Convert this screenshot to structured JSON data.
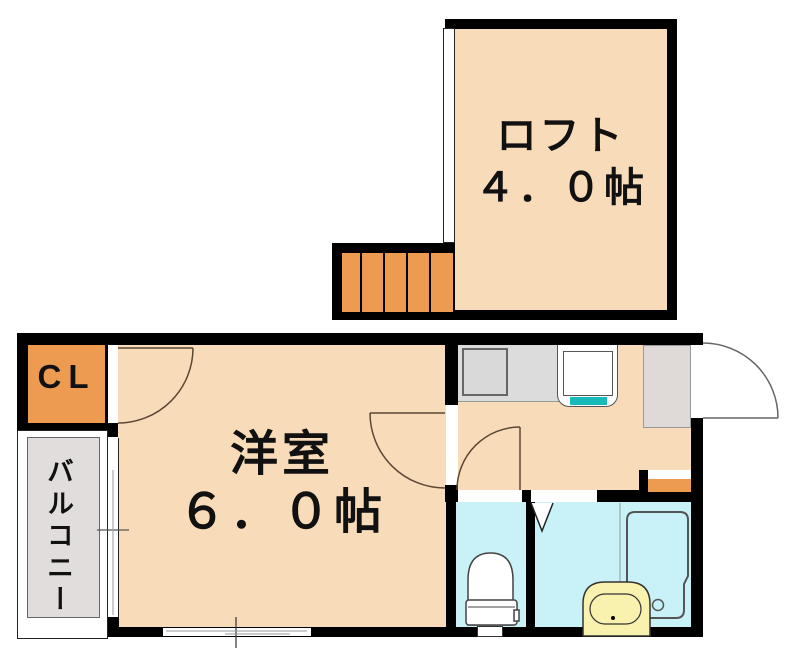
{
  "plan": {
    "type": "apartment-floor-plan",
    "rooms": {
      "loft": {
        "name": "ロフト",
        "size": "４．０帖"
      },
      "western_room": {
        "name": "洋室",
        "size": "６．０帖"
      },
      "closet": {
        "label": "CL"
      },
      "balcony": {
        "label": "バルコニー"
      }
    },
    "fixtures": [
      "stairs-icon",
      "stove-icon",
      "kitchen-sink-icon",
      "entrance-door-swing-icon",
      "room-door-swing-icon",
      "closet-door-swing-icon",
      "toilet-door-swing-icon",
      "folding-door-icon",
      "toilet-icon",
      "bathtub-icon",
      "washbasin-icon",
      "window-icon",
      "entrance-step"
    ],
    "colors": {
      "wall": "#000000",
      "floor_peach": "#F8DCBA",
      "accent_orange": "#EC9B51",
      "wet_area_cyan": "#C8F1F8",
      "sink_teal": "#18B9B9",
      "basin_yellow": "#F8F2AE",
      "counter_gray": "#DCDCDC",
      "balcony_gray": "#E2DDDD",
      "genkan_gray": "#DFDAD8",
      "door_arc": "#5C4733"
    }
  }
}
